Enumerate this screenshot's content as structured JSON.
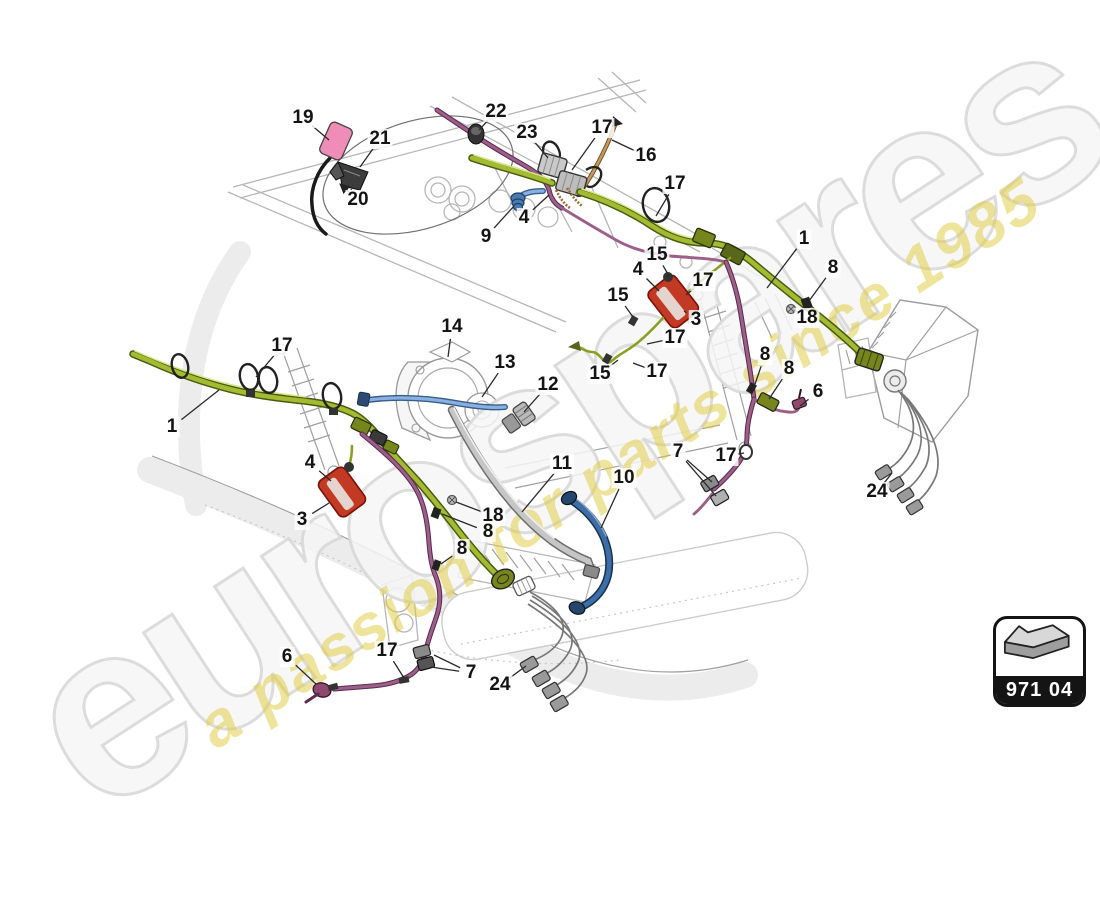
{
  "page": {
    "background": "#ffffff",
    "type": "exploded-parts-diagram"
  },
  "watermark": {
    "brand": "eurospares",
    "tagline": "a passion for parts since 1985",
    "brand_color": "#f4f4f4",
    "brand_outline": "#d8d8d8",
    "tagline_color": "#e0c938",
    "angle_deg": -33
  },
  "badge": {
    "code": "971 04",
    "icon": "direction-arrow-icon"
  },
  "colors": {
    "harness_green": "#a3bb31",
    "wire_purple": "#9c5f8a",
    "hose_blue": "#3d6ea6",
    "wire_lightblue": "#88b0e0",
    "hose_gray": "#c6c6c6",
    "wire_tan": "#c49a64",
    "part_red": "#c23a24",
    "part_pink": "#f08cb8",
    "lineart_gray": "#b6b6b6"
  },
  "callouts": [
    {
      "n": "19",
      "x": 303,
      "y": 118,
      "leads": [
        [
          329,
          140
        ]
      ]
    },
    {
      "n": "21",
      "x": 380,
      "y": 139,
      "leads": [
        [
          360,
          167
        ]
      ]
    },
    {
      "n": "22",
      "x": 496,
      "y": 112,
      "leads": [
        [
          479,
          130
        ]
      ]
    },
    {
      "n": "23",
      "x": 527,
      "y": 133,
      "leads": [
        [
          548,
          158
        ]
      ]
    },
    {
      "n": "17",
      "x": 602,
      "y": 128,
      "leads": [
        [
          572,
          170
        ]
      ]
    },
    {
      "n": "16",
      "x": 646,
      "y": 156,
      "leads": [
        [
          612,
          140
        ]
      ]
    },
    {
      "n": "20",
      "x": 358,
      "y": 200,
      "leads": [
        [
          351,
          189
        ],
        [
          340,
          184
        ]
      ],
      "arrow": true
    },
    {
      "n": "4",
      "x": 524,
      "y": 218,
      "leads": [
        [
          549,
          195
        ]
      ]
    },
    {
      "n": "9",
      "x": 486,
      "y": 237,
      "leads": [
        [
          514,
          206
        ]
      ]
    },
    {
      "n": "17",
      "x": 675,
      "y": 184,
      "leads": [
        [
          656,
          216
        ]
      ]
    },
    {
      "n": "15",
      "x": 657,
      "y": 255,
      "leads": [
        [
          669,
          276
        ]
      ]
    },
    {
      "n": "1",
      "x": 804,
      "y": 239,
      "leads": [
        [
          767,
          288
        ]
      ]
    },
    {
      "n": "4",
      "x": 638,
      "y": 270,
      "leads": [
        [
          659,
          291
        ]
      ]
    },
    {
      "n": "8",
      "x": 833,
      "y": 268,
      "leads": [
        [
          809,
          301
        ]
      ]
    },
    {
      "n": "15",
      "x": 618,
      "y": 296,
      "leads": [
        [
          633,
          317
        ]
      ]
    },
    {
      "n": "17",
      "x": 703,
      "y": 281,
      "leads": [
        [
          686,
          295
        ]
      ]
    },
    {
      "n": "3",
      "x": 696,
      "y": 320,
      "leads": [
        [
          684,
          311
        ]
      ]
    },
    {
      "n": "18",
      "x": 807,
      "y": 318,
      "leads": [
        [
          794,
          310
        ]
      ]
    },
    {
      "n": "17",
      "x": 675,
      "y": 338,
      "leads": [
        [
          647,
          344
        ]
      ]
    },
    {
      "n": "15",
      "x": 600,
      "y": 374,
      "leads": [
        [
          618,
          360
        ]
      ]
    },
    {
      "n": "17",
      "x": 657,
      "y": 372,
      "leads": [
        [
          633,
          363
        ]
      ]
    },
    {
      "n": "14",
      "x": 452,
      "y": 327,
      "leads": [
        [
          448,
          357
        ]
      ]
    },
    {
      "n": "13",
      "x": 505,
      "y": 363,
      "leads": [
        [
          482,
          397
        ]
      ]
    },
    {
      "n": "12",
      "x": 548,
      "y": 385,
      "leads": [
        [
          524,
          412
        ]
      ]
    },
    {
      "n": "11",
      "x": 562,
      "y": 464,
      "leads": [
        [
          522,
          512
        ]
      ]
    },
    {
      "n": "10",
      "x": 624,
      "y": 478,
      "leads": [
        [
          601,
          528
        ]
      ]
    },
    {
      "n": "7",
      "x": 678,
      "y": 452,
      "leads": [
        [
          712,
          482
        ],
        [
          716,
          496
        ]
      ]
    },
    {
      "n": "17",
      "x": 726,
      "y": 456,
      "leads": [
        [
          744,
          453
        ]
      ]
    },
    {
      "n": "6",
      "x": 818,
      "y": 392,
      "leads": [
        [
          800,
          406
        ]
      ]
    },
    {
      "n": "8",
      "x": 765,
      "y": 355,
      "leads": [
        [
          754,
          387
        ]
      ]
    },
    {
      "n": "8",
      "x": 789,
      "y": 369,
      "leads": [
        [
          769,
          399
        ]
      ]
    },
    {
      "n": "24",
      "x": 877,
      "y": 492,
      "leads": [
        [
          892,
          473
        ]
      ]
    },
    {
      "n": "17",
      "x": 282,
      "y": 346,
      "leads": [
        [
          256,
          377
        ]
      ]
    },
    {
      "n": "1",
      "x": 172,
      "y": 427,
      "leads": [
        [
          219,
          390
        ]
      ]
    },
    {
      "n": "4",
      "x": 310,
      "y": 463,
      "leads": [
        [
          331,
          481
        ]
      ]
    },
    {
      "n": "3",
      "x": 302,
      "y": 520,
      "leads": [
        [
          329,
          503
        ]
      ]
    },
    {
      "n": "18",
      "x": 493,
      "y": 516,
      "leads": [
        [
          456,
          502
        ]
      ]
    },
    {
      "n": "8",
      "x": 488,
      "y": 532,
      "leads": [
        [
          442,
          514
        ]
      ]
    },
    {
      "n": "8",
      "x": 462,
      "y": 549,
      "leads": [
        [
          441,
          564
        ]
      ]
    },
    {
      "n": "6",
      "x": 287,
      "y": 657,
      "leads": [
        [
          316,
          684
        ]
      ]
    },
    {
      "n": "17",
      "x": 387,
      "y": 651,
      "leads": [
        [
          404,
          678
        ]
      ]
    },
    {
      "n": "7",
      "x": 471,
      "y": 673,
      "leads": [
        [
          434,
          655
        ],
        [
          431,
          667
        ]
      ]
    },
    {
      "n": "24",
      "x": 500,
      "y": 685,
      "leads": [
        [
          526,
          666
        ]
      ]
    }
  ]
}
